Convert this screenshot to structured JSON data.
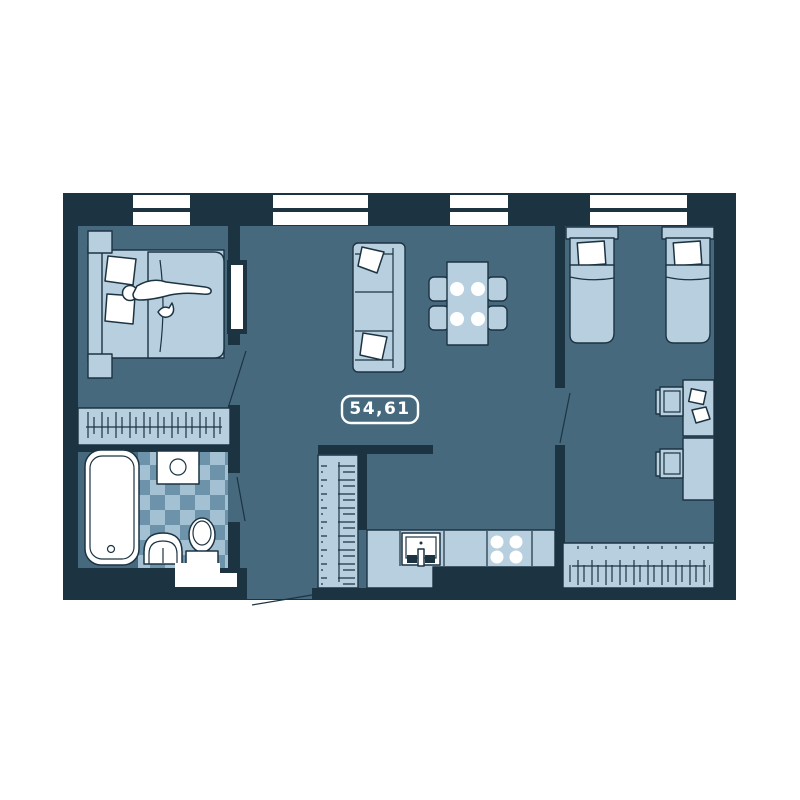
{
  "floor_plan": {
    "area_label": "54,61",
    "windows_count": 4,
    "furniture_visible": [
      "double-bed",
      "person-figure",
      "nightstand-top",
      "nightstand-bottom",
      "wall-mirror",
      "wardrobe-hangers-left",
      "bathtub",
      "washing-machine",
      "bathroom-sink",
      "toilet",
      "bathroom-cabinet",
      "sofa",
      "sofa-pillows",
      "dining-table",
      "dining-plates",
      "dining-chairs",
      "hall-closet-hangers",
      "kitchen-counter",
      "kitchen-sink",
      "stove-burners",
      "single-bed-1",
      "single-bed-2",
      "desk-1",
      "desk-2",
      "desk-chair-1",
      "desk-chair-2",
      "wardrobe-hangers-right",
      "door-swings",
      "entrance-door"
    ]
  },
  "colors": {
    "background": "#ffffff",
    "wall": "#1c3342",
    "floor": "#46697e",
    "furn_light": "#b7cfde",
    "furn_mid": "#8fb2c6",
    "tile_a": "#a3c1d2",
    "tile_b": "#6d93aa",
    "white": "#ffffff",
    "label_text": "#ffffff"
  }
}
